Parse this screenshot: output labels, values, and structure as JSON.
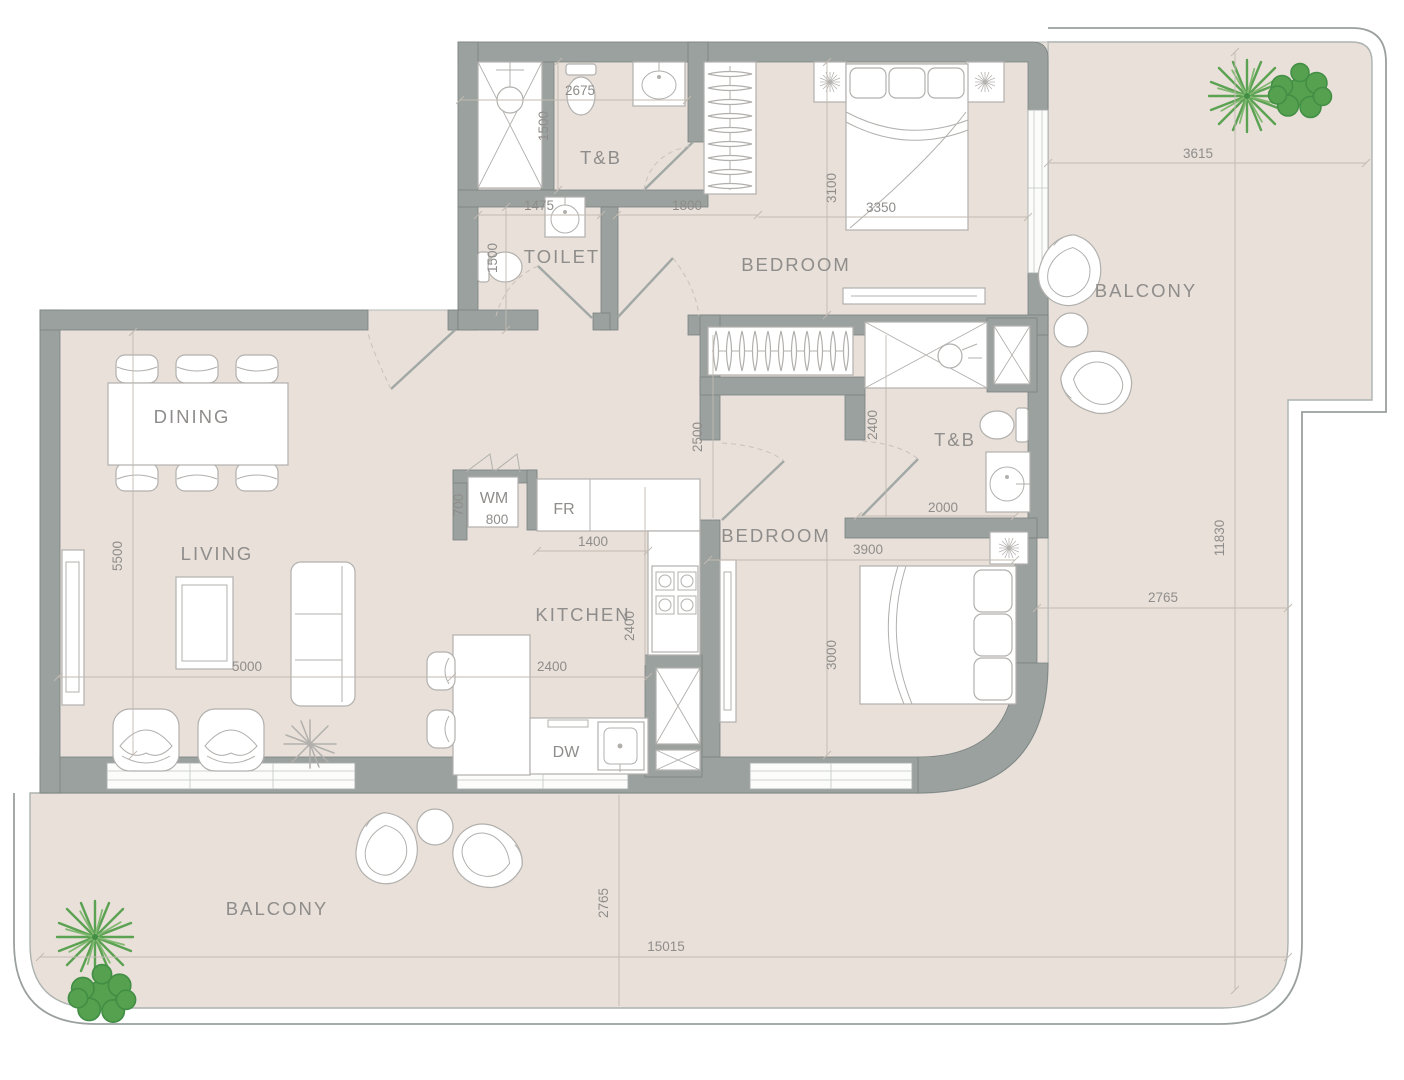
{
  "rooms": {
    "dining": "DINING",
    "living": "LIVING",
    "kitchen": "KITCHEN",
    "bedroom1": "BEDROOM",
    "bedroom2": "BEDROOM",
    "toilet": "TOILET",
    "tb1": "T&B",
    "tb2": "T&B",
    "balcony_top": "BALCONY",
    "balcony_bottom": "BALCONY"
  },
  "appliances": {
    "wm": "WM",
    "fr": "FR",
    "dw": "DW"
  },
  "dims": {
    "d2675": "2675",
    "d1500a": "1500",
    "d1475": "1475",
    "d1500b": "1500",
    "d1800": "1800",
    "d3100": "3100",
    "d3350": "3350",
    "d3615": "3615",
    "d2500": "2500",
    "d2400a": "2400",
    "d2000": "2000",
    "d3900": "3900",
    "d3000": "3000",
    "d700": "700",
    "d800": "800",
    "d1400": "1400",
    "d2400b": "2400",
    "d2400c": "2400",
    "d5500": "5500",
    "d5000": "5000",
    "d11830": "11830",
    "d2765a": "2765",
    "d2765b": "2765",
    "d15015": "15015"
  },
  "colors": {
    "floor": "#e8e0d9",
    "wall": "#9ba19f",
    "furniture_line": "#b2b0ad",
    "text": "#8f8d8b",
    "plant_green": "#5ca253",
    "background": "#ffffff"
  }
}
